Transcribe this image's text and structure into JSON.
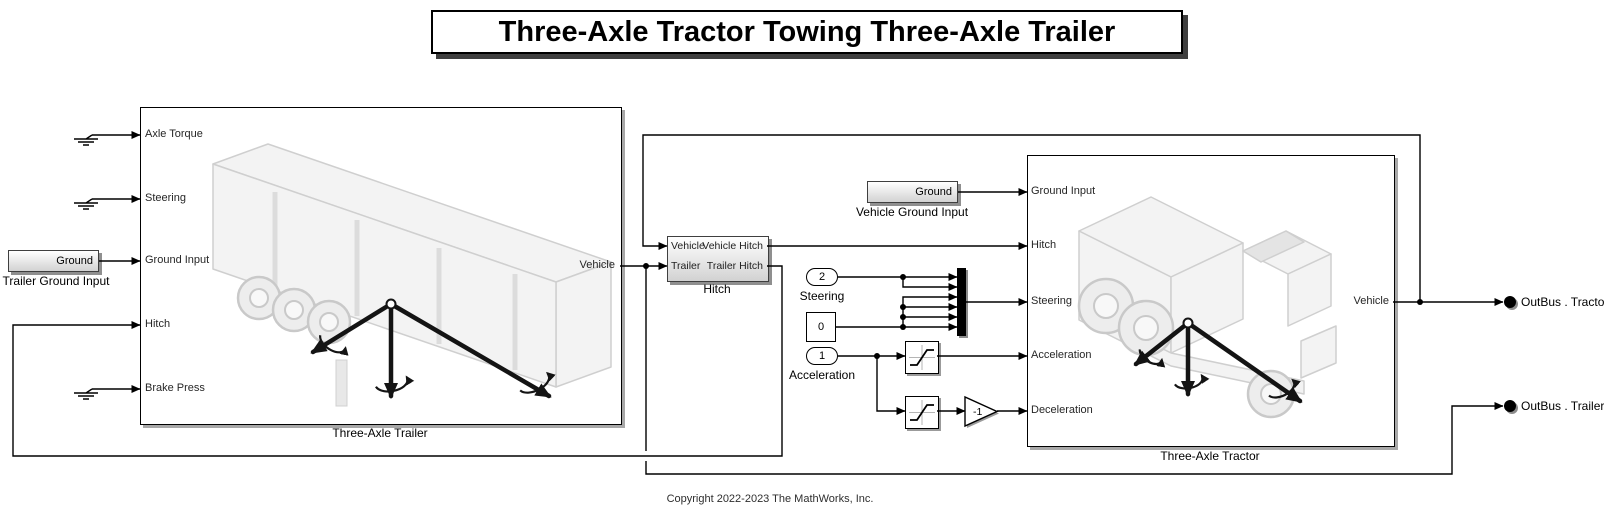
{
  "title": {
    "text": "Three-Axle Tractor Towing Three-Axle Trailer"
  },
  "footer": {
    "copyright": "Copyright 2022-2023 The MathWorks, Inc."
  },
  "palette": {
    "background": "#ffffff",
    "wire": "#000000",
    "subsystem_border": "#000000",
    "gradient_top": "#ffffff",
    "gradient_bottom": "#d2d2d2",
    "shadow": "#8f8f8f",
    "art_stroke": "#cfcfcf",
    "art_fill": "#f3f3f3",
    "mux_fill": "#000000"
  },
  "icons": {
    "ground_symbol": "electrical-ground-icon",
    "saturation": "saturation-curve-icon",
    "mux": "mux-bar",
    "gain": "gain-triangle",
    "terminator": "bus-terminator-dot",
    "triad": "vehicle-axes-arrows"
  },
  "trailer": {
    "caption": "Three-Axle Trailer",
    "ports_in": [
      "Axle Torque",
      "Steering",
      "Ground Input",
      "Hitch",
      "Brake Press"
    ],
    "port_out": "Vehicle"
  },
  "tractor": {
    "caption": "Three-Axle Tractor",
    "ports_in": [
      "Ground Input",
      "Hitch",
      "Steering",
      "Acceleration",
      "Deceleration"
    ],
    "port_out": "Vehicle"
  },
  "hitch": {
    "caption": "Hitch",
    "ports_in": [
      "Vehicle",
      "Trailer"
    ],
    "ports_out": [
      "Vehicle Hitch",
      "Trailer Hitch"
    ]
  },
  "grounds": {
    "trailer": {
      "text": "Ground",
      "caption": "Trailer Ground Input"
    },
    "vehicle": {
      "text": "Ground",
      "caption": "Vehicle Ground Input"
    }
  },
  "constants": {
    "steering": {
      "value": "2",
      "caption": "Steering"
    },
    "zero": {
      "value": "0"
    },
    "acceleration": {
      "value": "1",
      "caption": "Acceleration"
    }
  },
  "gain": {
    "value": "-1"
  },
  "outputs": {
    "tractor": "OutBus . Tractor",
    "trailer": "OutBus . Trailer"
  }
}
